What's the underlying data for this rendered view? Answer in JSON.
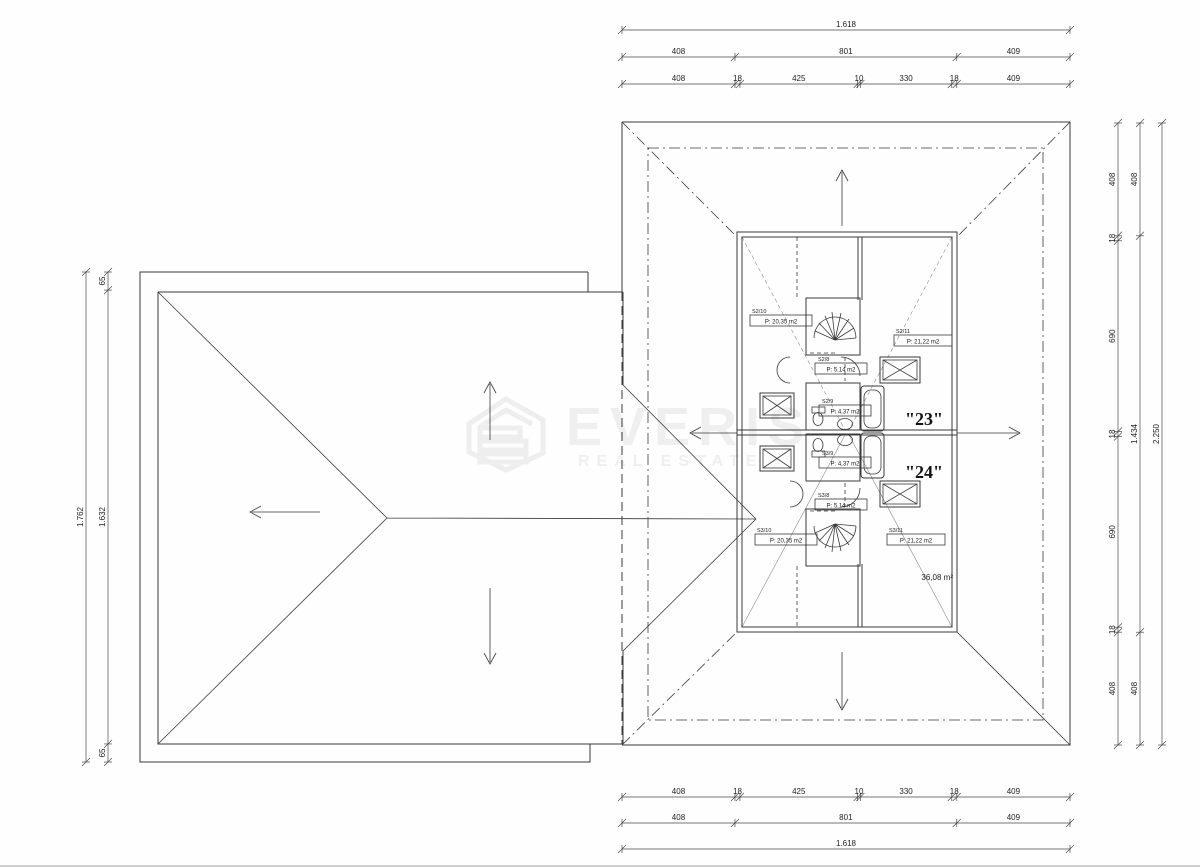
{
  "watermark": {
    "brand": "EVERIS",
    "tagline": "REAL ESTATE"
  },
  "plan": {
    "unit_upper_label": "\"23\"",
    "unit_lower_label": "\"24\"",
    "attic_area": "36,08 m²",
    "rooms": {
      "s2_10": {
        "id": "S2/10",
        "area": "P: 20,35 m2"
      },
      "s2_11": {
        "id": "S2/11",
        "area": "P: 21,22 m2"
      },
      "s2_8": {
        "id": "S2/8",
        "area": "P: 5,14 m2"
      },
      "s2_9": {
        "id": "S2/9",
        "area": "P: 4,37 m2"
      },
      "s3_9": {
        "id": "S3/9",
        "area": "P: 4,37 m2"
      },
      "s3_8": {
        "id": "S3/8",
        "area": "P: 5,14 m2"
      },
      "s3_10": {
        "id": "S3/10",
        "area": "P: 20,35 m2"
      },
      "s3_11": {
        "id": "S3/11",
        "area": "P: 21,22 m2"
      }
    }
  },
  "dimensions": {
    "horizontal": {
      "total": [
        "1.618"
      ],
      "thirds": [
        "408",
        "801",
        "409"
      ],
      "sevenths": [
        "408",
        "18",
        "425",
        "10",
        "330",
        "18",
        "409"
      ]
    },
    "right": {
      "inner": [
        "408",
        "18",
        "690",
        "18",
        "690",
        "18",
        "408"
      ],
      "middle": [
        "408",
        "1.434",
        "408"
      ],
      "outer": [
        "2.250"
      ]
    },
    "left": {
      "outer": [
        "1.762"
      ],
      "inner": [
        "65",
        "1.632",
        "65"
      ]
    }
  }
}
